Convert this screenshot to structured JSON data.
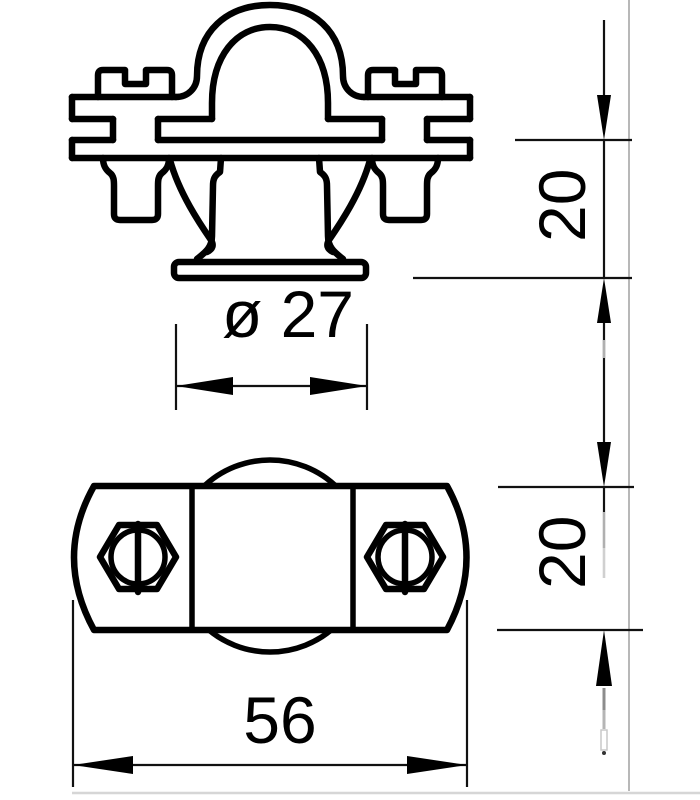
{
  "drawing": {
    "dimensions": {
      "diameter_label": "ø 27",
      "upper_height_label": "20",
      "lower_height_label": "20",
      "overall_width_label": "56"
    },
    "colors": {
      "line": "#000000",
      "background": "#ffffff",
      "projection_line": "#9a9a9a",
      "page_edge": "#d6d6d6"
    }
  }
}
